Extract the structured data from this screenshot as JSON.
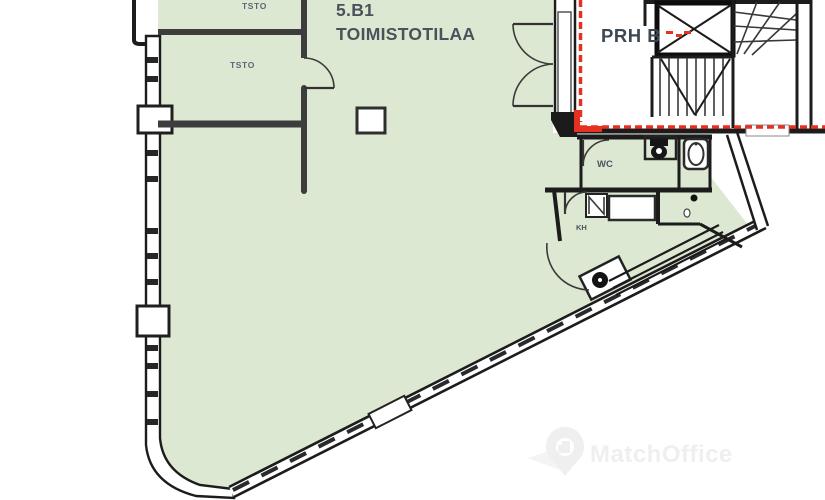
{
  "floorplan": {
    "unit": {
      "id": "5.B1",
      "type_label": "TOIMISTOTILAA"
    },
    "rooms": {
      "office_small_1": "TSTO",
      "office_small_2": "TSTO",
      "wc": "WC",
      "kh": "KH"
    },
    "stairwell": {
      "label": "PRH B"
    },
    "colors": {
      "area_fill": "#dde8d2",
      "wall_dark": "#1c1c1c",
      "wall_gray": "#3d3d3d",
      "boundary_red": "#e63022",
      "unit_text": "#4a525c",
      "room_text": "#5d6874",
      "stair_text": "#3d4852",
      "watermark": "#efefef"
    },
    "watermark": {
      "brand": "MatchOffice",
      "icon": "location-pin-icon"
    }
  }
}
